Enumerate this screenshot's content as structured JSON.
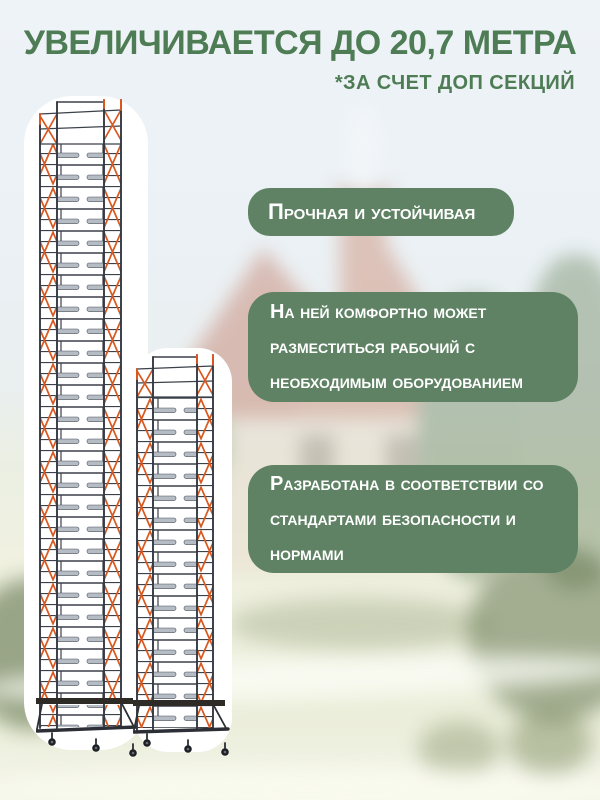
{
  "poster": {
    "title": "УВЕЛИЧИВАЕТСЯ ДО 20,7 МЕТРА",
    "subtitle": "*ЗА СЧЕТ ДОП СЕКЦИЙ",
    "features": [
      "Прочная и устойчивая",
      "На ней комфортно может разместиться рабочий с необходимым оборудованием",
      "Разработана в соответствии со стандартами безопасности и нормами"
    ],
    "illustrations": [
      {
        "name": "scaffold-tower-tall"
      },
      {
        "name": "scaffold-tower-short"
      }
    ],
    "colors": {
      "heading_green": "#4e7c55",
      "badge_green": "#5e8263",
      "badge_text": "#ffffff",
      "scaffold_frame": "#3b4049",
      "scaffold_brace_orange": "#d9581f",
      "scaffold_rung_gray": "#b6bcc4",
      "scaffold_platform": "#2e2a25",
      "background_sky": "#edf2f6",
      "background_field": "#eef0dd"
    }
  }
}
